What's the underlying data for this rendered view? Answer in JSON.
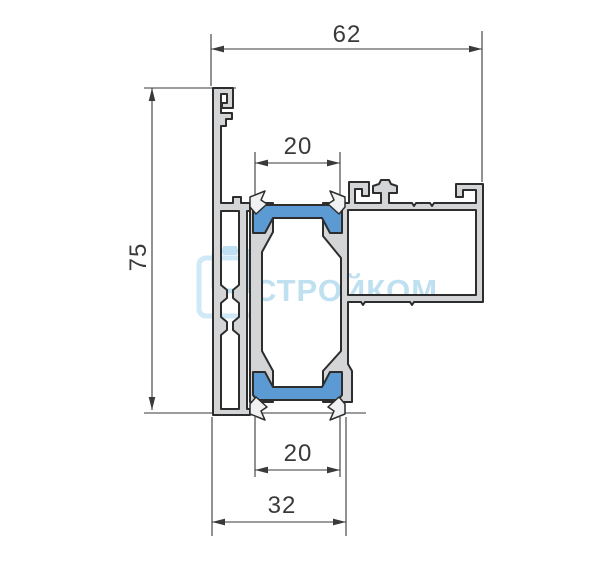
{
  "drawing": {
    "title": "aluminum-profile-cross-section",
    "dimensions": {
      "overall_width": "62",
      "overall_height": "75",
      "groove_top": "20",
      "groove_bottom": "20",
      "base_width": "32"
    },
    "watermark": {
      "text": "СТРОЙКОМ"
    },
    "colors": {
      "profile_fill": "#d3d5d7",
      "clip_fill": "#eff1f2",
      "outline": "#2d2d2d",
      "gasket_blue": "#5b9ad2",
      "dimension": "#3a3a3a",
      "watermark_blue": "#bfe0f0",
      "watermark_frame": "#cfe9f6"
    }
  }
}
